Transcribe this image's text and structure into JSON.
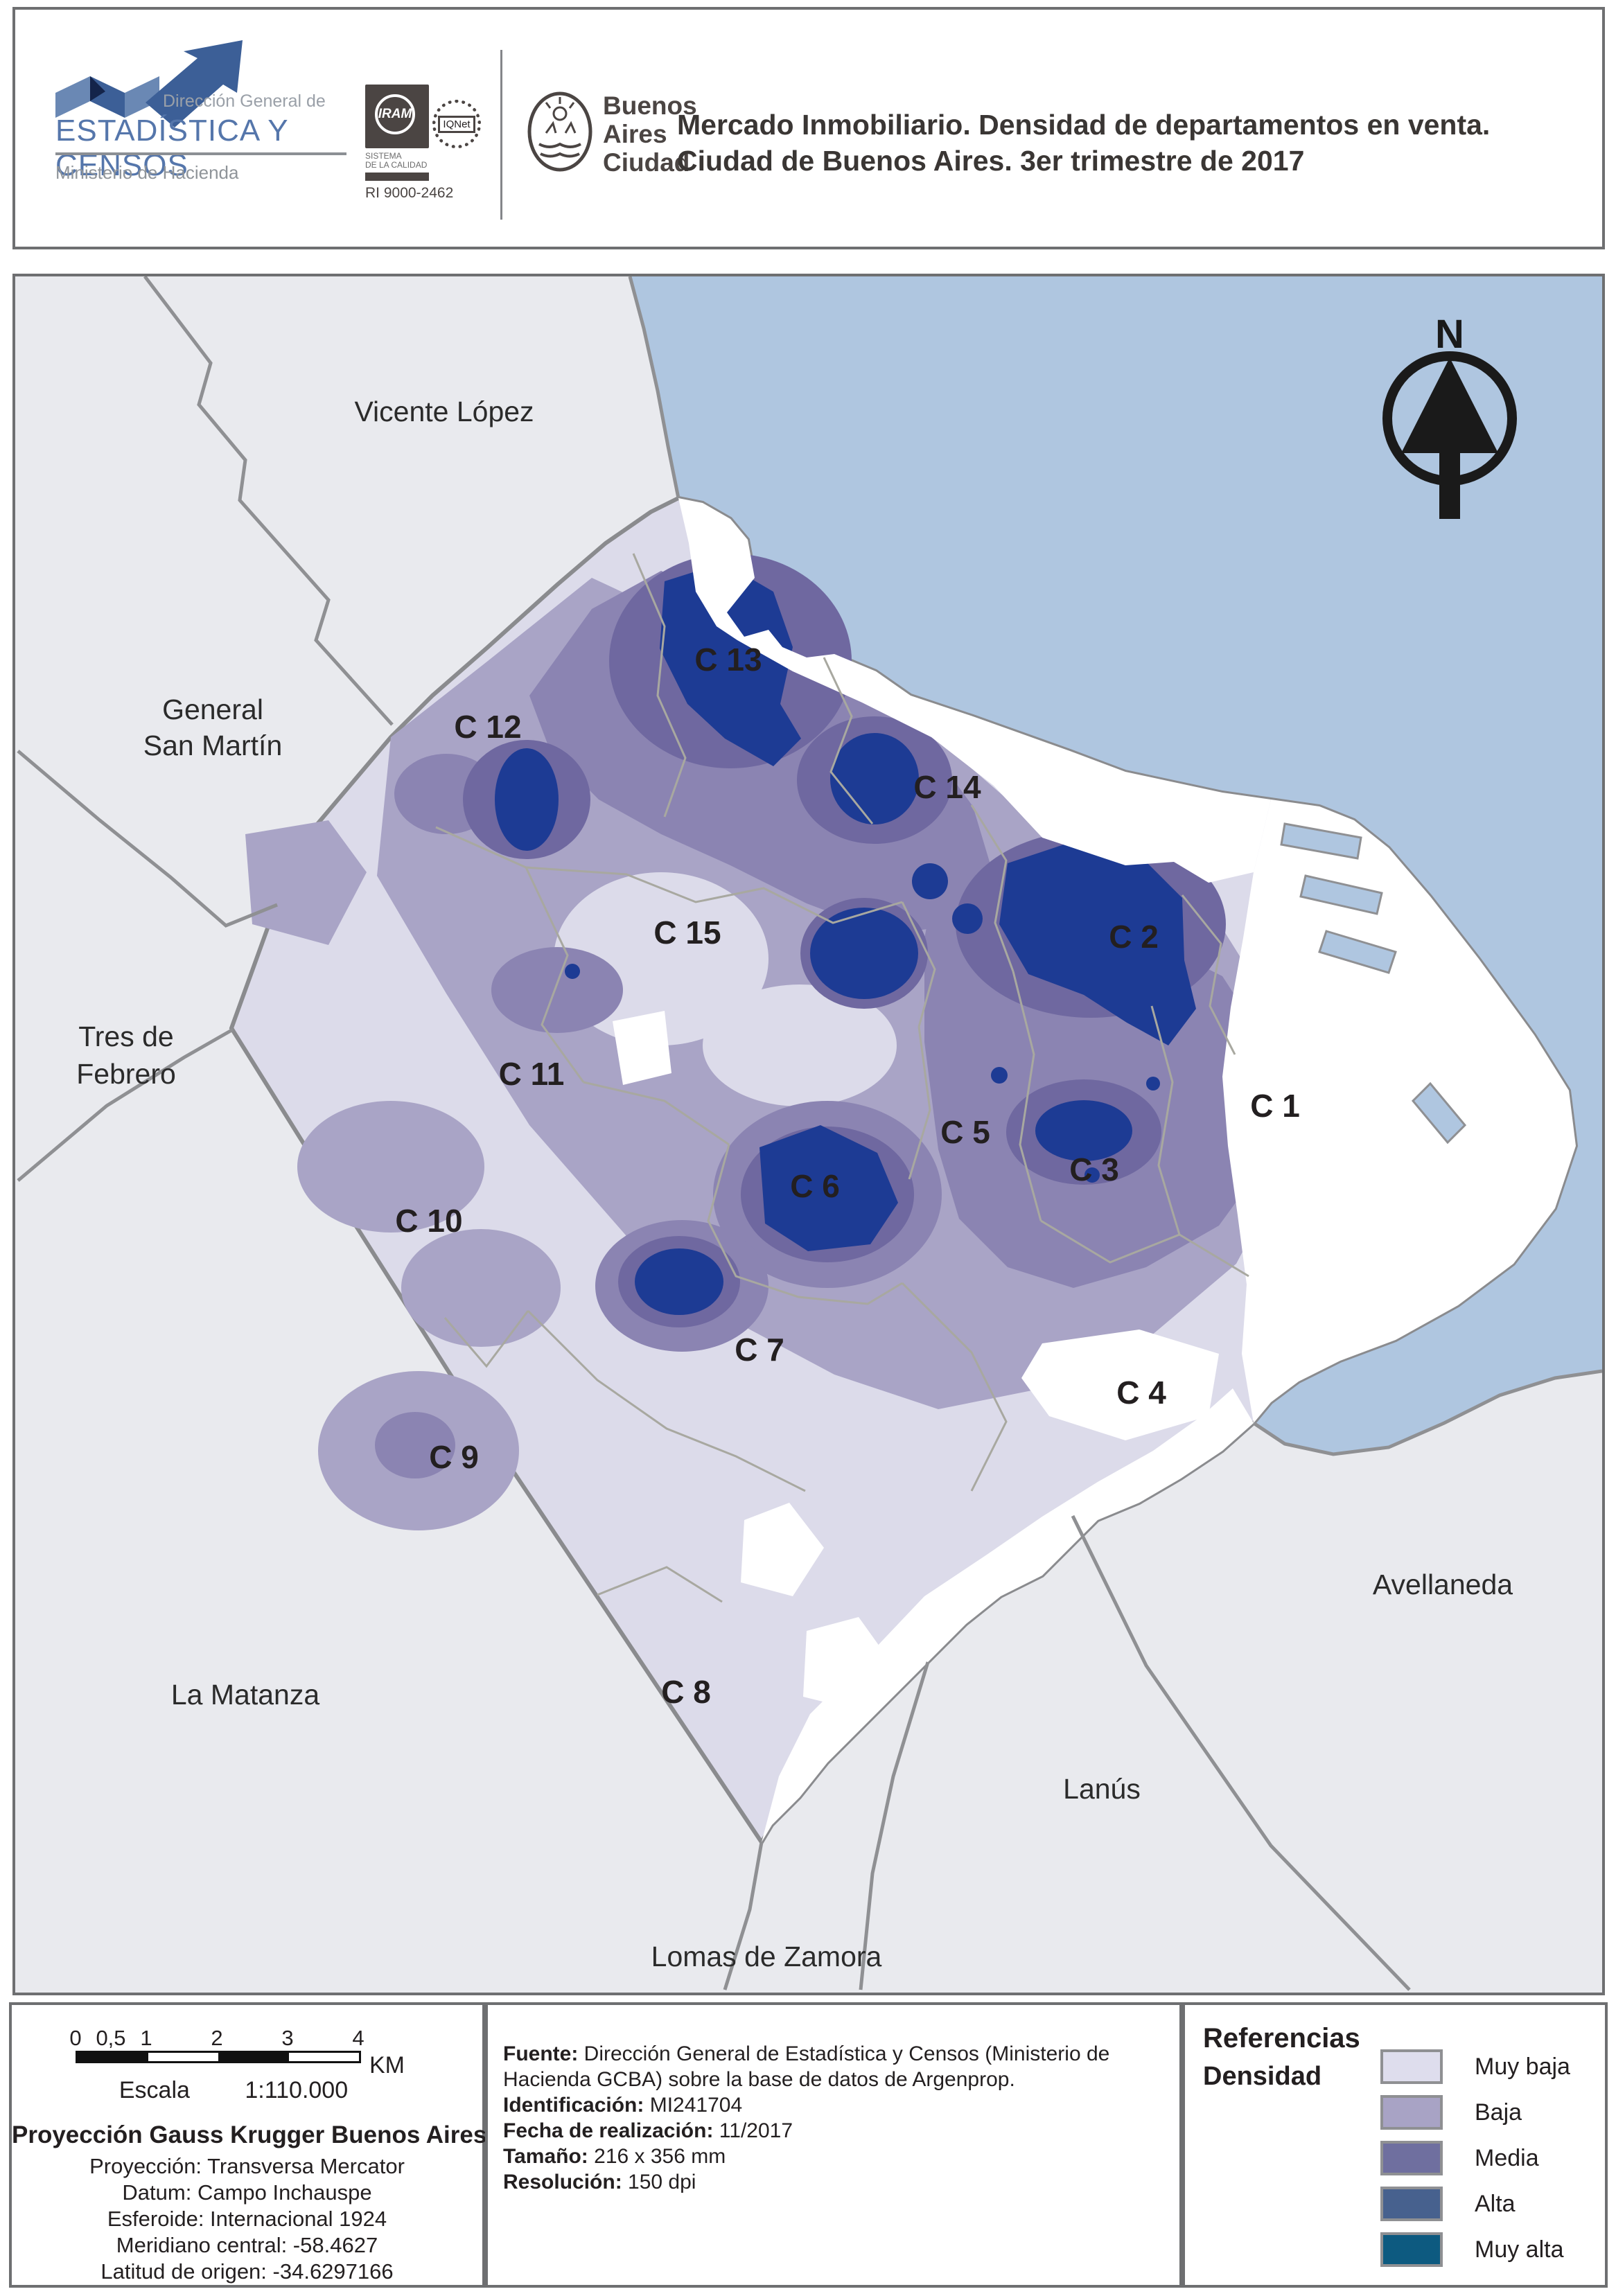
{
  "header": {
    "org_logo": {
      "line1": "Dirección General de",
      "line2": "ESTADÍSTICA Y CENSOS",
      "line3": "Ministerio de Hacienda"
    },
    "iram_logo": {
      "name": "IRAM",
      "sub_line1": "SISTEMA",
      "sub_line2": "DE LA CALIDAD",
      "cert": "RI 9000-2462"
    },
    "iqnet_logo": {
      "name": "IQNet"
    },
    "city_logo": {
      "line1": "Buenos",
      "line2": "Aires",
      "line3": "Ciudad"
    },
    "title_line1": "Mercado Inmobiliario. Densidad de departamentos en venta.",
    "title_line2": "Ciudad de Buenos Aires. 3er trimestre de 2017"
  },
  "map": {
    "north_label": "N",
    "communes": {
      "c1": "C 1",
      "c2": "C 2",
      "c3": "C 3",
      "c4": "C 4",
      "c5": "C 5",
      "c6": "C 6",
      "c7": "C 7",
      "c8": "C 8",
      "c9": "C 9",
      "c10": "C 10",
      "c11": "C 11",
      "c12": "C 12",
      "c13": "C 13",
      "c14": "C 14",
      "c15": "C 15"
    },
    "neighbors": {
      "vicente_lopez": "Vicente López",
      "general_san_martin_l1": "General",
      "general_san_martin_l2": "San Martín",
      "tres_de_febrero_l1": "Tres de",
      "tres_de_febrero_l2": "Febrero",
      "la_matanza": "La Matanza",
      "lomas_de_zamora": "Lomas de Zamora",
      "lanus": "Lanús",
      "avellaneda": "Avellaneda"
    }
  },
  "footer": {
    "scalebar": {
      "ticks": [
        "0",
        "0,5",
        "1",
        "2",
        "3",
        "4"
      ],
      "unit": "KM",
      "escala_label": "Escala",
      "escala_value": "1:110.000"
    },
    "projection": {
      "title": "Proyección Gauss Krugger Buenos Aires",
      "line1": "Proyección: Transversa Mercator",
      "line2": "Datum: Campo Inchauspe",
      "line3": "Esferoide: Internacional 1924",
      "line4": "Meridiano central: -58.4627",
      "line5": "Latitud de origen: -34.6297166"
    },
    "source": {
      "fuente_label": "Fuente:",
      "fuente_text": "Dirección General de Estadística y Censos (Ministerio de Hacienda GCBA) sobre la base de datos de Argenprop.",
      "id_label": "Identificación:",
      "id_value": "MI241704",
      "fecha_label": "Fecha de realización:",
      "fecha_value": "11/2017",
      "tamano_label": "Tamaño:",
      "tamano_value": "216 x 356 mm",
      "resolucion_label": "Resolución:",
      "resolucion_value": "150 dpi"
    },
    "legend": {
      "title": "Referencias",
      "subtitle": "Densidad",
      "items": [
        {
          "label": "Muy baja",
          "color": "#dedded"
        },
        {
          "label": "Baja",
          "color": "#a8a3c5"
        },
        {
          "label": "Media",
          "color": "#6f6f9f"
        },
        {
          "label": "Alta",
          "color": "#47618e"
        },
        {
          "label": "Muy alta",
          "color": "#0d5a80"
        }
      ]
    }
  },
  "colors": {
    "river": "#afc6e0",
    "outside_municipalities": "#e9eaee",
    "density_muy_baja": "#dcdbea",
    "density_baja": "#a9a4c6",
    "density_media": "#8b84b2",
    "density_alta_band": "#6f68a0",
    "density_hotspot": "#1d3b94",
    "frame_border": "#6e6f71",
    "boundary_line": "#8f9093"
  }
}
